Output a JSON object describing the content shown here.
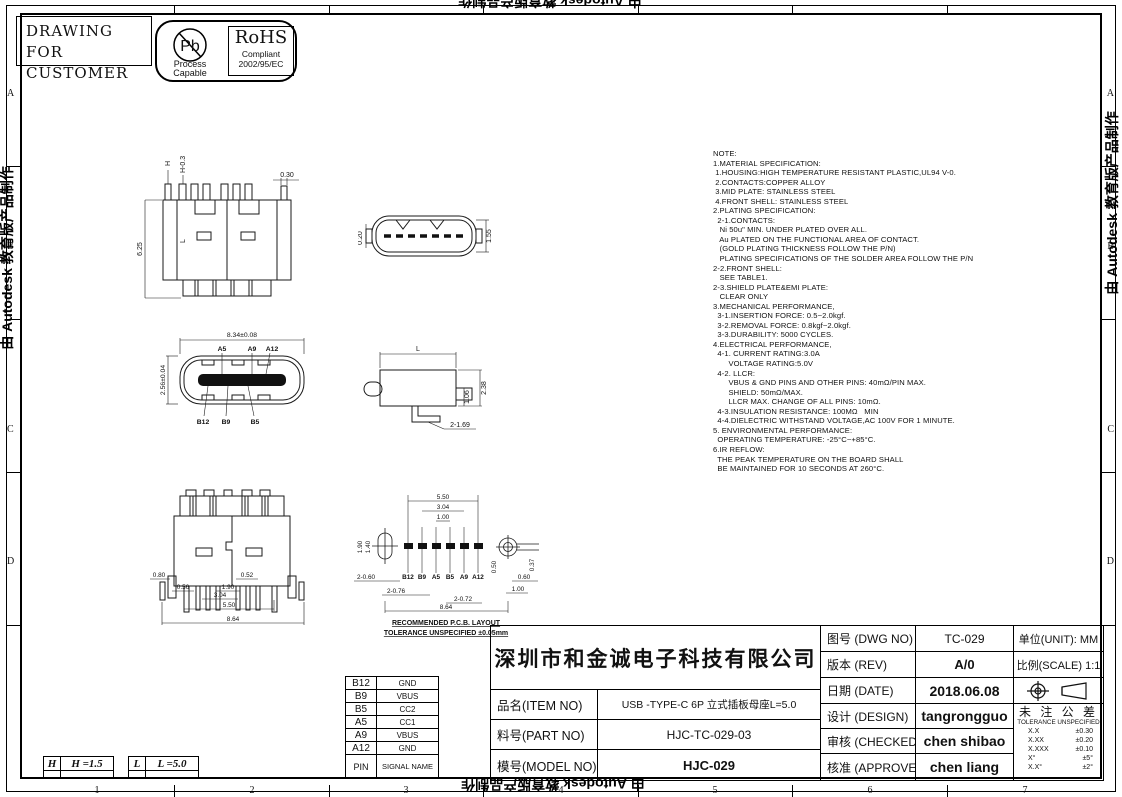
{
  "watermark": {
    "text": "由 Autodesk 教育版产品制作"
  },
  "header": {
    "drawing_for_line1": "DRAWING FOR",
    "drawing_for_line2": "CUSTOMER",
    "pb_symbol": "Pb",
    "pb_caption_line1": "Process",
    "pb_caption_line2": "Capable",
    "rohs_title": "RoHS",
    "rohs_line1": "Compliant",
    "rohs_line2": "2002/95/EC"
  },
  "note": {
    "lines": [
      "NOTE:",
      "1.MATERIAL SPECIFICATION:",
      " 1.HOUSING:HIGH TEMPERATURE RESISTANT PLASTIC,UL94 V-0.",
      " 2.CONTACTS:COPPER ALLOY",
      " 3.MID PLATE: STAINLESS STEEL",
      " 4.FRONT SHELL: STAINLESS STEEL",
      "2.PLATING SPECIFICATION:",
      "  2-1.CONTACTS:",
      "   Ni 50u\" MIN. UNDER PLATED OVER ALL.",
      "   Au PLATED ON THE FUNCTIONAL AREA OF CONTACT.",
      "   (GOLD PLATING THICKNESS FOLLOW THE P/N)",
      "   PLATING SPECIFICATIONS OF THE SOLDER AREA FOLLOW THE P/N",
      "2-2.FRONT SHELL:",
      "   SEE TABLE1.",
      "2-3.SHIELD PLATE&EMI PLATE:",
      "   CLEAR ONLY",
      "3.MECHANICAL PERFORMANCE,",
      "  3-1.INSERTION FORCE: 0.5~2.0kgf.",
      "  3-2.REMOVAL FORCE: 0.8kgf~2.0kgf.",
      "  3-3.DURABILITY: 5000 CYCLES.",
      "4.ELECTRICAL PERFORMANCE,",
      "  4-1. CURRENT RATING:3.0A",
      "       VOLTAGE RATING:5.0V",
      "  4-2. LLCR:",
      "       VBUS & GND PINS AND OTHER PINS: 40mΩ/PIN MAX.",
      "       SHIELD: 50mΩ/MAX.",
      "       LLCR MAX. CHANGE OF ALL PINS: 10mΩ.",
      "  4-3.INSULATION RESISTANCE: 100MΩ   MIN",
      "  4-4.DIELECTRIC WITHSTAND VOLTAGE,AC 100V FOR 1 MINUTE.",
      "5. ENVIRONMENTAL PERFORMANCE:",
      "  OPERATING TEMPERATURE: -25°C~+85°C.",
      "6.IR REFLOW:",
      "  THE PEAK TEMPERATURE ON THE BOARD SHALL",
      "  BE MAINTAINED FOR 10 SECONDS AT 260°C."
    ]
  },
  "views": {
    "front": {
      "dim_h": "H",
      "dim_h2": "H-0.3",
      "dim_030": "0.30",
      "dim_625": "6.25",
      "dim_l": "L"
    },
    "top": {
      "dim_020": "0.20",
      "dim_155": "1.55"
    },
    "face": {
      "dim_width": "8.34±0.08",
      "dim_height": "2.56±0.04",
      "pin_a5": "A5",
      "pin_a9": "A9",
      "pin_a12": "A12",
      "pin_b12": "B12",
      "pin_b9": "B9",
      "pin_b5": "B5"
    },
    "side": {
      "dim_l": "L",
      "dim_106": "1.06",
      "dim_238": "2.38",
      "dim_holes": "2-1.69"
    },
    "back": {
      "dim_080": "0.80",
      "dim_056": "0.56",
      "dim_304": "3.04",
      "dim_190": "1.90",
      "dim_052": "0.52",
      "dim_550": "5.50",
      "dim_864": "8.64"
    },
    "pcb": {
      "dim_550": "5.50",
      "dim_304": "3.04",
      "dim_100": "1.00",
      "dim_190": "1.90",
      "dim_140": "1.40",
      "dim_2_060": "2-0.60",
      "dim_2_076": "2-0.76",
      "dim_2_072": "2-0.72",
      "dim_050": "0.50",
      "dim_060": "0.60",
      "dim_100b": "1.00",
      "dim_037": "0.37",
      "dim_864": "8.64",
      "pads": [
        "B12",
        "B9",
        "A5",
        "B5",
        "A9",
        "A12"
      ],
      "caption_line1": "RECOMMENDED  P.C.B. LAYOUT",
      "caption_line2": "TOLERANCE UNSPECIFIED ±0.05mm"
    }
  },
  "pin_table": {
    "rows": [
      {
        "pin": "B12",
        "signal": "GND"
      },
      {
        "pin": "B9",
        "signal": "VBUS"
      },
      {
        "pin": "B5",
        "signal": "CC2"
      },
      {
        "pin": "A5",
        "signal": "CC1"
      },
      {
        "pin": "A9",
        "signal": "VBUS"
      },
      {
        "pin": "A12",
        "signal": "GND"
      }
    ],
    "footer": {
      "pin": "PIN",
      "signal": "SIGNAL NAME"
    }
  },
  "param_tables": {
    "h": {
      "key": "H",
      "value": "H =1.5"
    },
    "l": {
      "key": "L",
      "value": "L =5.0"
    }
  },
  "title_block": {
    "company": "深圳市和金诚电子科技有限公司",
    "item_label": "品名(ITEM NO)",
    "item_value": "USB -TYPE-C 6P 立式插板母座L=5.0",
    "part_label": "料号(PART NO)",
    "part_value": "HJC-TC-029-03",
    "model_label": "模号(MODEL NO)",
    "model_value": "HJC-029",
    "dwg_label": "图号 (DWG NO)",
    "dwg_value": "TC-029",
    "unit_label": "单位(UNIT): MM",
    "rev_label": "版本 (REV)",
    "rev_value": "A/0",
    "scale_label": "比例(SCALE) 1:1",
    "date_label": "日期 (DATE)",
    "date_value": "2018.06.08",
    "design_label": "设计 (DESIGN)",
    "design_value": "tangrongguo",
    "checked_label": "审核 (CHECKED)",
    "checked_value": "chen shibao",
    "approved_label": "核准 (APPROVED)",
    "approved_value": "chen liang",
    "tol_title": "未 注 公 差",
    "tol_subtitle": "TOLERANCE UNSPECIFIED",
    "tolerances": [
      {
        "k": "X.X",
        "v": "±0.30"
      },
      {
        "k": "X.XX",
        "v": "±0.20"
      },
      {
        "k": "X.XXX",
        "v": "±0.10"
      },
      {
        "k": "X°",
        "v": "±5°"
      },
      {
        "k": "X.X°",
        "v": "±2°"
      }
    ]
  },
  "border": {
    "bottom_zones": [
      "1",
      "2",
      "3",
      "4",
      "5",
      "6",
      "7"
    ],
    "left_zones": [
      "A",
      "B",
      "C",
      "D"
    ],
    "right_zones": [
      "A",
      "B",
      "C",
      "D"
    ]
  }
}
